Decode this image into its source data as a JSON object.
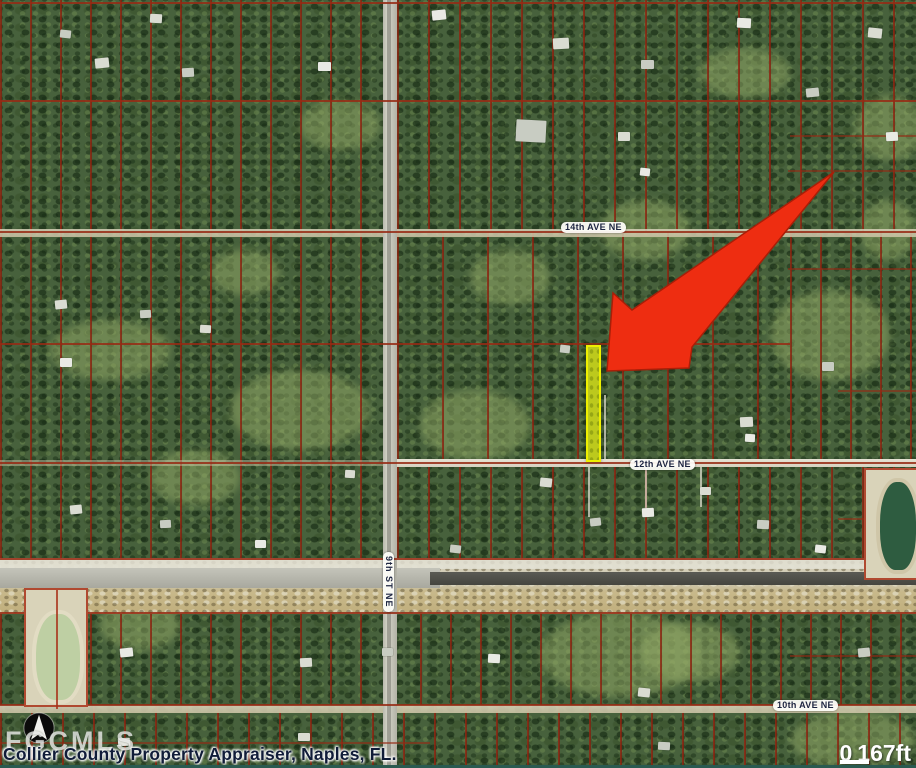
{
  "map": {
    "attribution": "Collier County Property Appraiser, Naples, FL.",
    "watermark": "FGCMLS",
    "scale_bar": {
      "start_label": "0",
      "end_label": "167ft"
    },
    "street_labels": [
      {
        "id": "ave14",
        "text": "14th AVE NE"
      },
      {
        "id": "ave12",
        "text": "12th AVE NE"
      },
      {
        "id": "ave10",
        "text": "10th AVE NE"
      },
      {
        "id": "st9",
        "text": "9th ST NE"
      }
    ],
    "colors": {
      "arrow": "#ee2d11",
      "arrow_edge": "#a81f08",
      "parcel_line": "#962a14",
      "highlight_fill": "#bcc91d",
      "highlight_border": "#eef000",
      "label_text": "#1c2440",
      "attribution_text": "#101c38"
    }
  }
}
